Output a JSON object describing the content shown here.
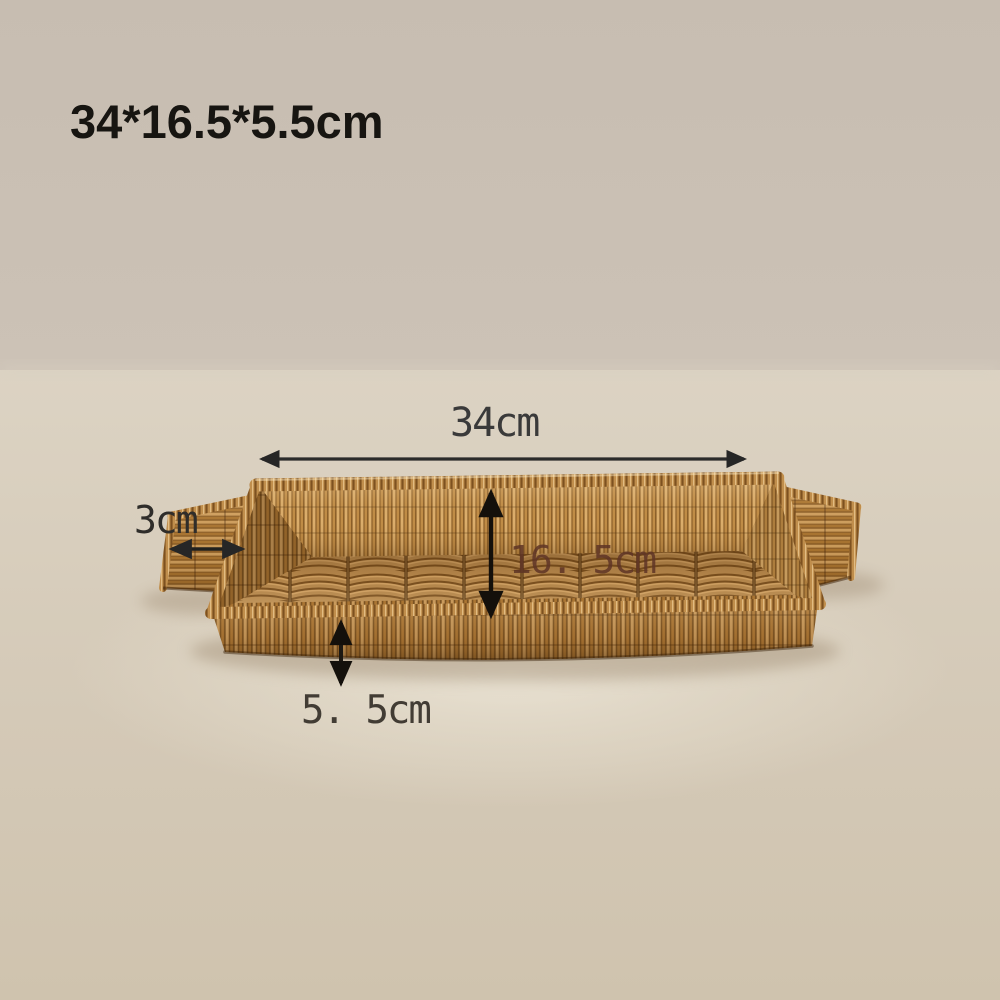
{
  "photo": {
    "subject": "rattan-wicker-serving-tray-with-handles",
    "size_title": "34*16.5*5.5cm",
    "dimensions": {
      "width": "34cm",
      "handle_width": "3cm",
      "inner_depth": "16. 5cm",
      "side_height": "5. 5cm"
    },
    "colors": {
      "background_top": "#c7bdb1",
      "background_bottom": "#cfc3ae",
      "surface_highlight": "#eae3d4",
      "wicker_light": "#d2a263",
      "wicker_mid": "#b07c38",
      "wicker_dark": "#7a5222",
      "annotation_dark": "#262626",
      "annotation_black": "#14100b",
      "annotation_brown": "#5f3526"
    }
  }
}
